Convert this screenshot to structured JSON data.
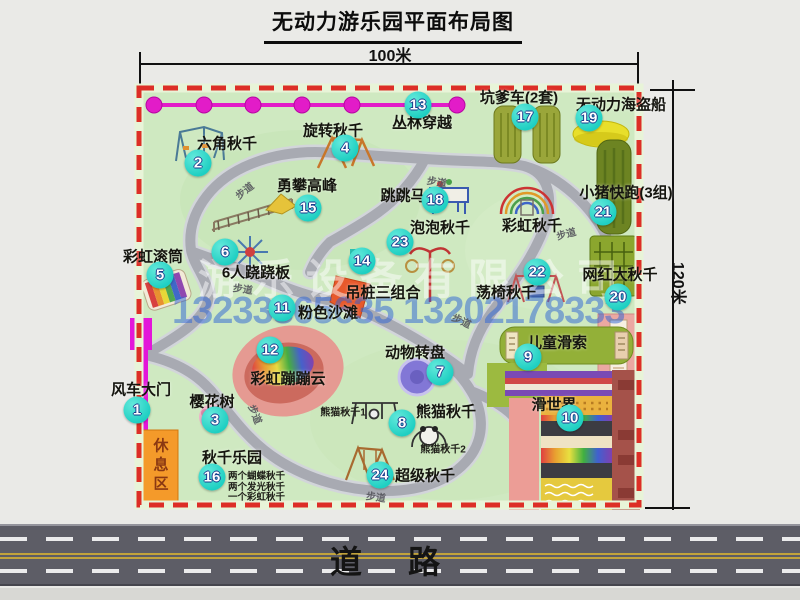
{
  "title": "无动力游乐园平面布局图",
  "dimensions": {
    "width_label": "100米",
    "height_label": "120米"
  },
  "road": {
    "label": "道路"
  },
  "watermark": {
    "company": "游乐设备有限公司",
    "phone": "13233865635 13202178333"
  },
  "colors": {
    "map_green": "#cfe9c1",
    "border_red": "#dd2e26",
    "badge_teal": "#1ecfc2",
    "zipline_magenta": "#e21cc8",
    "gate_magenta": "#e316d9",
    "rest_orange": "#f49a2a",
    "road_gray": "#5d5d66"
  },
  "map": {
    "path_label_text": "步道",
    "attractions": [
      {
        "num": "1",
        "label": "风车大门",
        "badge": [
          137,
          410
        ],
        "label_pos": [
          141,
          389
        ]
      },
      {
        "num": "2",
        "label": "六角秋千",
        "badge": [
          198,
          163
        ],
        "label_pos": [
          227,
          143
        ]
      },
      {
        "num": "3",
        "label": "樱花树",
        "badge": [
          215,
          420
        ],
        "label_pos": [
          212,
          401
        ]
      },
      {
        "num": "4",
        "label": "旋转秋千",
        "badge": [
          345,
          148
        ],
        "label_pos": [
          333,
          130
        ]
      },
      {
        "num": "5",
        "label": "彩虹滚筒",
        "badge": [
          160,
          275
        ],
        "label_pos": [
          153,
          256
        ]
      },
      {
        "num": "6",
        "label": "6人跷跷板",
        "badge": [
          225,
          252
        ],
        "label_pos": [
          256,
          272
        ]
      },
      {
        "num": "7",
        "label": "动物转盘",
        "badge": [
          440,
          372
        ],
        "label_pos": [
          415,
          352
        ]
      },
      {
        "num": "8",
        "label": "熊猫秋千",
        "badge": [
          402,
          423
        ],
        "label_pos": [
          446,
          411
        ]
      },
      {
        "num": "9",
        "label": "儿童滑索",
        "badge": [
          528,
          357
        ],
        "label_pos": [
          557,
          342
        ]
      },
      {
        "num": "10",
        "label": "滑世界",
        "badge": [
          570,
          418
        ],
        "label_pos": [
          554,
          404
        ]
      },
      {
        "num": "11",
        "label": "粉色沙滩",
        "badge": [
          282,
          308
        ],
        "label_pos": [
          328,
          312
        ]
      },
      {
        "num": "12",
        "label": "彩虹蹦蹦云",
        "badge": [
          270,
          350
        ],
        "label_pos": [
          288,
          378
        ]
      },
      {
        "num": "13",
        "label": "丛林穿越",
        "badge": [
          418,
          105
        ],
        "label_pos": [
          422,
          122
        ]
      },
      {
        "num": "14",
        "label": "吊桩三组合",
        "badge": [
          362,
          261
        ],
        "label_pos": [
          383,
          292
        ]
      },
      {
        "num": "15",
        "label": "勇攀高峰",
        "badge": [
          308,
          208
        ],
        "label_pos": [
          307,
          185
        ]
      },
      {
        "num": "16",
        "label": "秋千乐园",
        "badge": [
          212,
          477
        ],
        "label_pos": [
          232,
          457
        ],
        "notes": [
          "两个蝴蝶秋千",
          "两个发光秋千",
          "一个彩虹秋千"
        ],
        "notes_xy": [
          228,
          468
        ]
      },
      {
        "num": "17",
        "label": "坑爹车(2套)",
        "badge": [
          525,
          117
        ],
        "label_pos": [
          519,
          97
        ]
      },
      {
        "num": "18",
        "label": "跳跳马",
        "badge": [
          435,
          200
        ],
        "label_pos": [
          403,
          195
        ]
      },
      {
        "num": "19",
        "label": "无动力海盗船",
        "badge": [
          589,
          118
        ],
        "label_pos": [
          621,
          104
        ]
      },
      {
        "num": "20",
        "label": "网红大秋千",
        "badge": [
          618,
          297
        ],
        "label_pos": [
          620,
          274
        ]
      },
      {
        "num": "21",
        "label": "小猪快跑(3组)",
        "badge": [
          603,
          212
        ],
        "label_pos": [
          626,
          192
        ]
      },
      {
        "num": "22",
        "label": "荡椅秋千",
        "badge": [
          537,
          272
        ],
        "label_pos": [
          506,
          292
        ]
      },
      {
        "num": "23",
        "label": "泡泡秋千",
        "badge": [
          400,
          242
        ],
        "label_pos": [
          440,
          227
        ]
      },
      {
        "num": "24",
        "label": "超级秋千",
        "badge": [
          380,
          475
        ],
        "label_pos": [
          425,
          475
        ]
      }
    ],
    "extra_labels": [
      {
        "text": "彩虹秋千",
        "x": 532,
        "y": 225,
        "cls": "lbl"
      },
      {
        "text": "熊猫秋千1",
        "x": 343,
        "y": 411,
        "cls": "note2"
      },
      {
        "text": "熊猫秋千2",
        "x": 443,
        "y": 448,
        "cls": "note2"
      },
      {
        "text": "休息区",
        "x": 160,
        "y": 466,
        "cls": "vert"
      }
    ],
    "path_labels": [
      {
        "x": 244,
        "y": 190,
        "rot": -38
      },
      {
        "x": 437,
        "y": 181,
        "rot": 10
      },
      {
        "x": 566,
        "y": 233,
        "rot": -15
      },
      {
        "x": 243,
        "y": 288,
        "rot": 8
      },
      {
        "x": 256,
        "y": 414,
        "rot": 68
      },
      {
        "x": 462,
        "y": 320,
        "rot": 25
      },
      {
        "x": 376,
        "y": 496,
        "rot": 8
      }
    ]
  }
}
